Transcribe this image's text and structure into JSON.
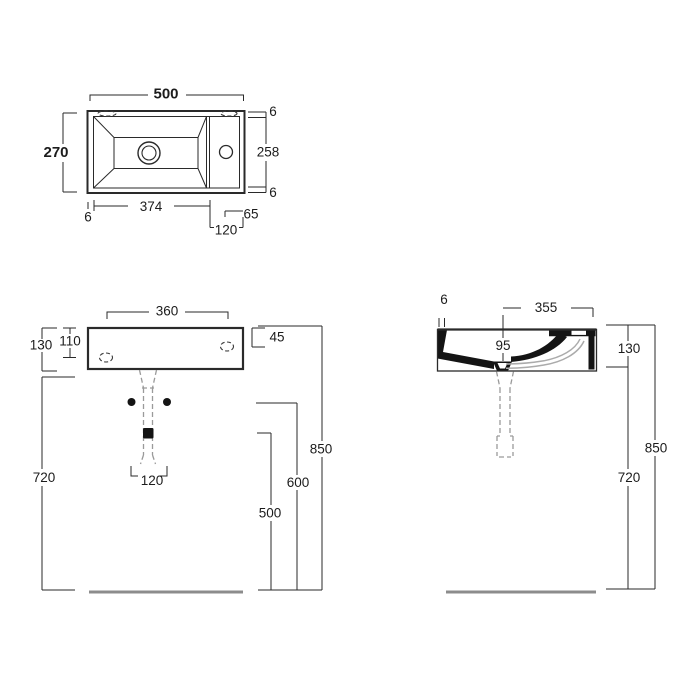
{
  "top_view": {
    "width": "500",
    "depth": "270",
    "rim_top": "6",
    "basin_depth": "258",
    "rim_bottom": "6",
    "rim_left": "6",
    "basin_width": "374",
    "tap_deck_width": "120",
    "tap_hole_to_edge": "65"
  },
  "front_view": {
    "fixing_hole_span": "360",
    "body_height": "130",
    "fixing_hole_drop": "110",
    "tap_hole_drop": "45",
    "bolt_span": "120",
    "floor_to_underside": "720",
    "floor_to_trap": "500",
    "floor_to_bolts": "600",
    "floor_to_rim": "850"
  },
  "side_view": {
    "rim_thickness": "6",
    "drain_to_wall": "355",
    "drain_offset": "95",
    "body_height": "130",
    "floor_to_underside": "720",
    "floor_to_rim": "850"
  }
}
